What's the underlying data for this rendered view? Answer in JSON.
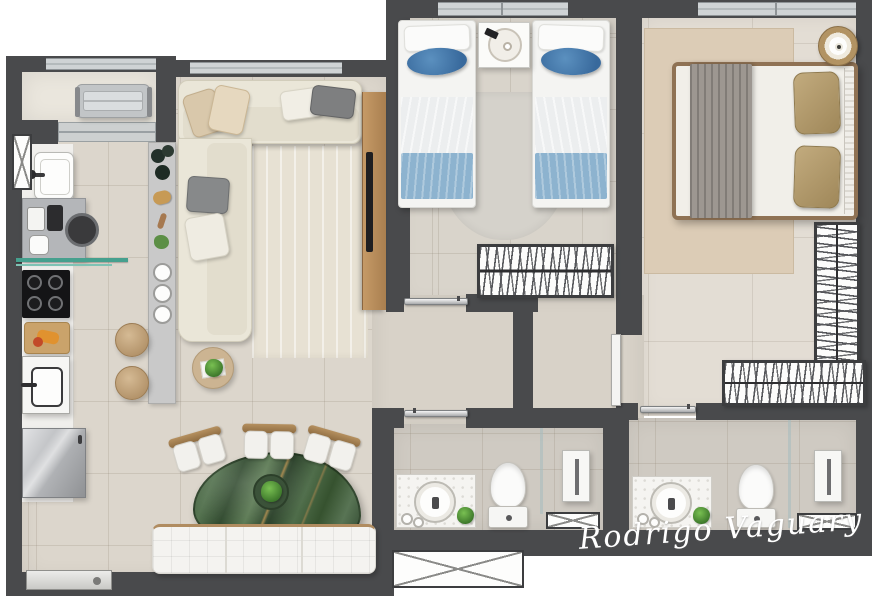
{
  "watermark": {
    "text": "Rodrigo Vaguary"
  },
  "palette": {
    "wall": "#494a4c",
    "floor_living": "#dcd6cc",
    "floor_bedroom_twin": "#d9d4cb",
    "floor_bedroom_master": "#e3ddd4",
    "floor_bath": "#cfcac2",
    "floor_balcony": "#eae6dd",
    "sofa_cream": "#eae6d8",
    "bed_blue_pillow": "#3f76a9",
    "bed_blue_throw": "#8db3cf",
    "master_pillow_tan": "#b49c70",
    "table_green_marble": "#44603f",
    "wood_accent": "#b5905f",
    "steel_appliance": "#b9babd",
    "signature": "#ffffff"
  },
  "rooms": {
    "balcony": {
      "items": [
        "ac-unit",
        "window"
      ]
    },
    "kitchen": {
      "items": [
        "laundry-sink",
        "washing-machine",
        "coffee-station",
        "glass-shelf",
        "cooktop",
        "cutting-board",
        "kitchen-sink",
        "refrigerator",
        "island-counter",
        "stool",
        "stool"
      ]
    },
    "living_room": {
      "items": [
        "l-shaped-sofa",
        "throw-pillows",
        "rug",
        "tv-panel",
        "tv",
        "side-table",
        "plant",
        "window"
      ]
    },
    "dining_area": {
      "items": [
        "green-marble-table",
        "plant-centerpiece",
        "chair",
        "chair",
        "chair",
        "tufted-bench",
        "entry-door"
      ]
    },
    "bedroom_twin": {
      "items": [
        "single-bed",
        "single-bed",
        "nightstand",
        "serving-tray",
        "rug",
        "wardrobe-hangers",
        "window",
        "door"
      ]
    },
    "bedroom_master": {
      "items": [
        "double-bed",
        "gray-throw",
        "tan-pillows",
        "headboard",
        "round-pouf",
        "rug",
        "l-shaped-wardrobe-hangers",
        "window",
        "door"
      ]
    },
    "bathroom_1": {
      "items": [
        "vanity-counter",
        "basin",
        "faucet",
        "towels",
        "plant",
        "toilet",
        "glass-partition",
        "shower-column",
        "shower-tray",
        "door"
      ]
    },
    "bathroom_2": {
      "items": [
        "vanity-counter",
        "basin",
        "faucet",
        "towels",
        "plant",
        "toilet",
        "glass-partition",
        "shower-column",
        "shower-tray",
        "door"
      ]
    }
  }
}
